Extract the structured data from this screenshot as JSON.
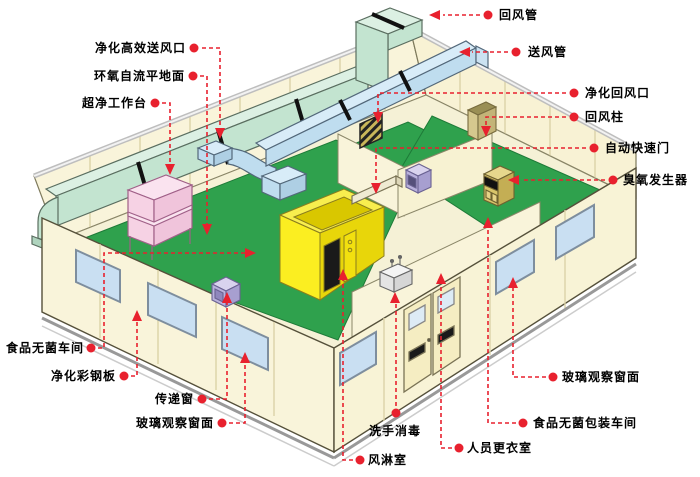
{
  "colors": {
    "annotation_red": "#E8212E",
    "wall_cream": "#F9F4DA",
    "wall_seam": "#DCD3A8",
    "floor_green": "#2FA14D",
    "return_duct_green": "#C3E4D0",
    "supply_duct_blue": "#BFDDEF",
    "air_shower_yellow": "#F7EC1E",
    "workbench_pink": "#F6D2E4",
    "transfer_box_purple": "#B9B1DC",
    "window_blue": "#C9DFF2",
    "ozone_tan": "#D8C46A"
  },
  "labels": [
    {
      "id": "return-air-duct",
      "text": "回风管"
    },
    {
      "id": "supply-air-duct",
      "text": "送风管"
    },
    {
      "id": "purified-return-air-inlet",
      "text": "净化回风口"
    },
    {
      "id": "return-air-column",
      "text": "回风柱"
    },
    {
      "id": "automatic-fast-door",
      "text": "自动快速门"
    },
    {
      "id": "ozone-generator",
      "text": "臭氧发生器"
    },
    {
      "id": "hepa-supply-air-outlet",
      "text": "净化高效送风口"
    },
    {
      "id": "epoxy-self-leveling-floor",
      "text": "环氧自流平地面"
    },
    {
      "id": "ultra-clean-workbench",
      "text": "超净工作台"
    },
    {
      "id": "food-sterile-workshop",
      "text": "食品无菌车间"
    },
    {
      "id": "purification-color-steel-panel",
      "text": "净化彩钢板"
    },
    {
      "id": "transfer-window",
      "text": "传递窗"
    },
    {
      "id": "glass-observation-window-left",
      "text": "玻璃观察窗面"
    },
    {
      "id": "hand-wash-disinfection",
      "text": "洗手消毒"
    },
    {
      "id": "air-shower-room",
      "text": "风淋室"
    },
    {
      "id": "personnel-changing-room",
      "text": "人员更衣室"
    },
    {
      "id": "glass-observation-window-right",
      "text": "玻璃观察窗面"
    },
    {
      "id": "food-sterile-packaging-workshop",
      "text": "食品无菌包装车间"
    }
  ]
}
